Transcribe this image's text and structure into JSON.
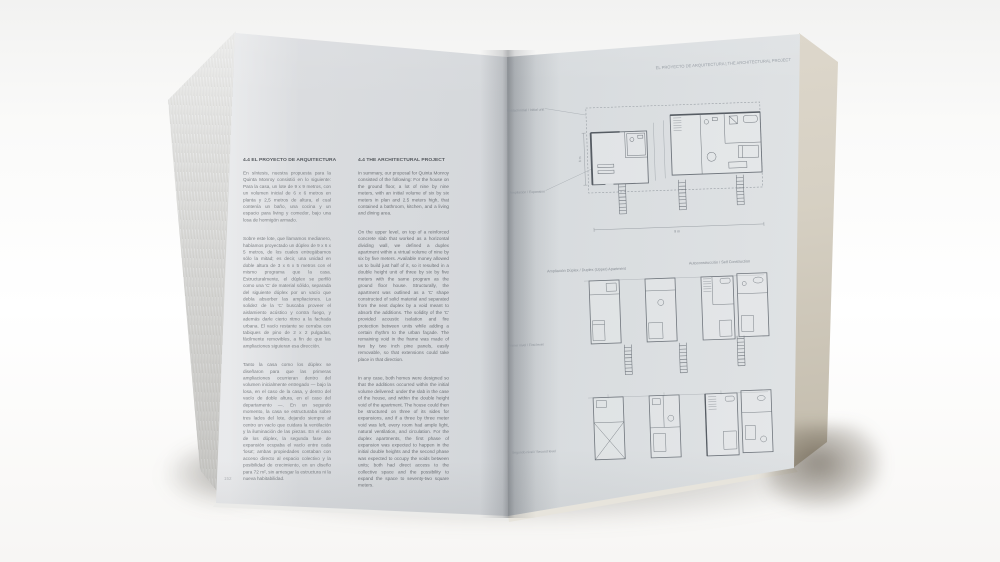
{
  "colors": {
    "left_page": "#d6d9dc",
    "right_page": "#d3d8dc",
    "fore_edge": "#d6d0c3",
    "plan_line": "#70767d"
  },
  "left_page": {
    "section_heading_es": "4.4 EL PROYECTO DE ARQUITECTURA",
    "section_heading_en": "4.4 THE ARCHITECTURAL PROJECT",
    "paragraphs_es": [
      "En síntesis, nuestra propuesta para la Quinta Monroy consistió en lo siguiente: Para la casa, un lote de 9 x 9 metros, con un volumen inicial de 6 x 6 metros en planta y 2,5 metros de altura, el cual contenía un baño, una cocina y un espacio para living y comedor, bajo una losa de hormigón armado.",
      "Sobre este lote, que llamamos medianero, habíamos proyectado un dúplex de 9 x 6 x 5 metros, de los cuales entregábamos sólo la mitad; es decir, una unidad en doble altura de 3 x 6 x 5 metros con el mismo programa que la casa. Estructuralmente, el dúplex se perfiló como una 'C' de material sólido, separada del siguiente dúplex por un vacío que debía absorber las ampliaciones. La solidez de la 'C' buscaba proveer el aislamiento acústico y contra fuego, y además darle cierto ritmo a la fachada urbana. El vacío restante se cerraba con tabiques de pino de 2 x 2 pulgadas, fácilmente removibles, a fin de que las ampliaciones siguieran esa dirección.",
      "Tanto la casa como los dúplex se diseñaron para que las primeras ampliaciones ocurrieran dentro del volumen inicialmente entregado — bajo la losa, en el caso de la casa, y dentro del vacío de doble altura, en el caso del departamento —. En un segundo momento, la casa se estructuraba sobre tres lados del lote, dejando siempre al centro un vacío que cuidara la ventilación y la iluminación de las piezas. En el caso de los dúplex, la segunda fase de expansión ocupaba el vacío entre cada 'losa'; ambas propiedades contaban con acceso directo al espacio colectivo y la posibilidad de crecimiento, en un diseño para 72 m², sin arriesgar la estructura ni la nueva habitabilidad."
    ],
    "paragraphs_en": [
      "In summary, our proposal for Quinta Monroy consisted of the following: For the house on the ground floor, a lot of nine by nine meters, with an initial volume of six by six meters in plan and 2.5 meters high, that contained a bathroom, kitchen, and a living and dining area.",
      "On the upper level, on top of a reinforced concrete slab that worked as a horizontal dividing wall, we defined a duplex apartment within a virtual volume of nine by six by five meters. Available money allowed us to build just half of it, so it resulted in a double height unit of three by six by five meters with the same program as the ground floor house. Structurally, the apartment was outlined as a 'C' shape constructed of solid material and separated from the next duplex by a void meant to absorb the additions. The solidity of the 'C' provided acoustic isolation and fire protection between units while adding a certain rhythm to the urban façade. The remaining void in the frame was made of two by two inch pine panels, easily removable, so that extensions could take place in that direction.",
      "In any case, both homes were designed so that the additions occurred within the initial volume delivered: under the slab in the case of the house, and within the double height void of the apartment. The house could then be structured on three of its sides for expansions, and if a three by three meter void was left, every room had ample light, natural ventilation, and circulation. For the duplex apartments, the first phase of expansion was expected to happen in the initial double heights and the second phase was expected to occupy the voids between units; both had direct access to the collective space and the possibility to expand the space to seventy-two square meters."
    ],
    "page_number": "152"
  },
  "right_page": {
    "running_header": "EL PROYECTO DE ARQUITECTURA | THE ARCHITECTURAL PROJECT",
    "captions": {
      "duplex": "Ampliación Dúplex / Duplex (Upper) Apartment",
      "self_construction": "Autoconstrucción / Self Construction"
    },
    "figure_top": {
      "label_initial": "Unidad inicial / Initial unit",
      "label_expansion": "Ampliación / Expansion",
      "dim_width": "9 m",
      "dim_height": "6 m"
    },
    "figure_bottom": {
      "label_level1": "Primer nivel / First level",
      "label_level2": "Segundo nivel / Second level"
    }
  }
}
